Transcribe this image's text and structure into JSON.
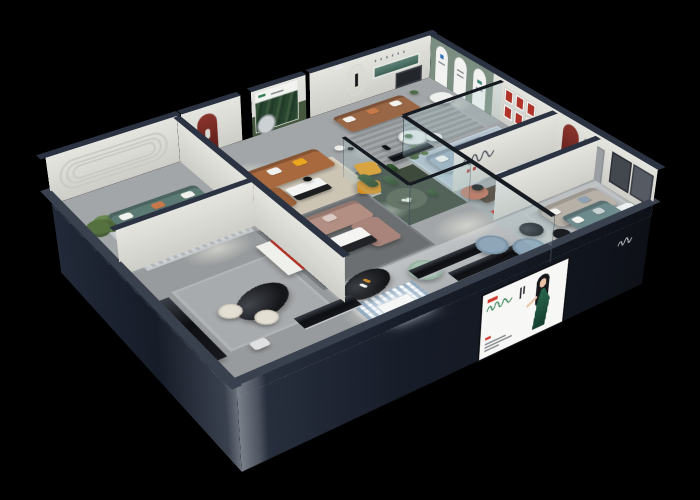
{
  "scene": {
    "name": "Isometric night cutaway render of a furniture showroom",
    "background": "#000000"
  },
  "palette": {
    "exterior_wall": "#1b2230",
    "wall_parapet": "#2b3342",
    "interior_wall": "#dcdcd6",
    "floor": "#a3a6a8",
    "atrium_green": "#3e4a3b",
    "sage_feature_wall": "#7b8e81",
    "red_niche": "#7c2a22",
    "teal_sofa": "#5c7a74",
    "cognac_sofa": "#a8693f",
    "mauve_sofa": "#b28e83",
    "brown_sofa": "#9a6746",
    "blue_sofa": "#9cb0c2",
    "yellow_accent": "#eaa61d",
    "coral_accent": "#bf6e55",
    "mint_accent": "#a7c2b2"
  },
  "building": {
    "name": "showroom-building"
  },
  "rooms": [
    {
      "name": "Teal sofa lounge with oval wall moulding and potted plant"
    },
    {
      "name": "Cognac leather sofa room with red arched niche and floor lamp"
    },
    {
      "name": "Forest mural nook with moss wall and round mirror"
    },
    {
      "name": "Brown leather lounge with teal wall niche, oval mirror and yellow sling chairs"
    },
    {
      "name": "Sage gallery wall with three white arches and cream armchair"
    },
    {
      "name": "Light blue sofa room with red artwork grid wall"
    },
    {
      "name": "White sectional room with walnut dining table and red arch niche"
    },
    {
      "name": "Greige modular sofa room with dark wall panels and white daybed"
    },
    {
      "name": "Mauve sectional lounge with drinks table and mint barrel chair"
    },
    {
      "name": "Glazed cactus atrium"
    },
    {
      "name": "Black bar nook with oval counter, cream stools and red-trim shelf"
    },
    {
      "name": "Front display aisle with benches, glowing showcase and lounge set"
    }
  ],
  "billboard": {
    "subject": "Illustrated hostess in a dark green halter dress",
    "panel_color": "#f7f7f5",
    "logo_red": "#cf3b2f",
    "logo_green": "#2e7d4f",
    "dress_green": "#1c4f3d",
    "hair_black": "#15161a"
  },
  "signs": {
    "partition_script_logo": "cursive brand script with small red characters",
    "parapet_script_logo": "white cursive brand script on dark parapet",
    "wall_letter_dots": "small spaced brand letters above teal wall slot"
  }
}
